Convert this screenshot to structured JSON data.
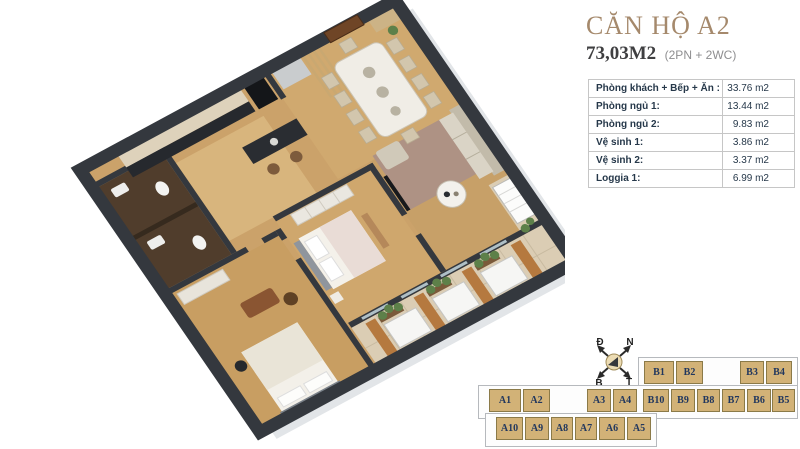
{
  "title": {
    "heading": "CĂN HỘ A2",
    "area": "73,03M2",
    "area_note": "(2PN + 2WC)"
  },
  "room_table": {
    "rows": [
      {
        "label": "Phòng khách + Bếp + Ăn :",
        "value": "33.76 m2"
      },
      {
        "label": "Phòng ngủ 1:",
        "value": "13.44 m2"
      },
      {
        "label": "Phòng ngủ 2:",
        "value": "9.83 m2"
      },
      {
        "label": "Vệ sinh 1:",
        "value": "3.86 m2"
      },
      {
        "label": "Vệ sinh 2:",
        "value": "3.37 m2"
      },
      {
        "label": "Loggia 1:",
        "value": "6.99 m2"
      }
    ]
  },
  "compass": {
    "nw": "Đ",
    "ne": "N",
    "sw": "B",
    "se": "T"
  },
  "unit_map": {
    "strip1": [
      "B1",
      "B2",
      "B3",
      "B4"
    ],
    "strip2": [
      "A1",
      "A2",
      "A3",
      "A4",
      "B10",
      "B9",
      "B8",
      "B7",
      "B6",
      "B5"
    ],
    "strip3": [
      "A10",
      "A9",
      "A8",
      "A7",
      "A6",
      "A5"
    ]
  },
  "colors": {
    "title_text": "#a5896c",
    "table_text": "#26384a",
    "unit_fill": "#d2b277",
    "unit_border": "#8b7a48",
    "unit_text": "#21375e",
    "wall": "#34383e",
    "wood_floor": "#cba26a",
    "bathroom_tile": "#503d2c",
    "balcony_tile": "#dbcdb4",
    "plant_green": "#5d8049"
  }
}
